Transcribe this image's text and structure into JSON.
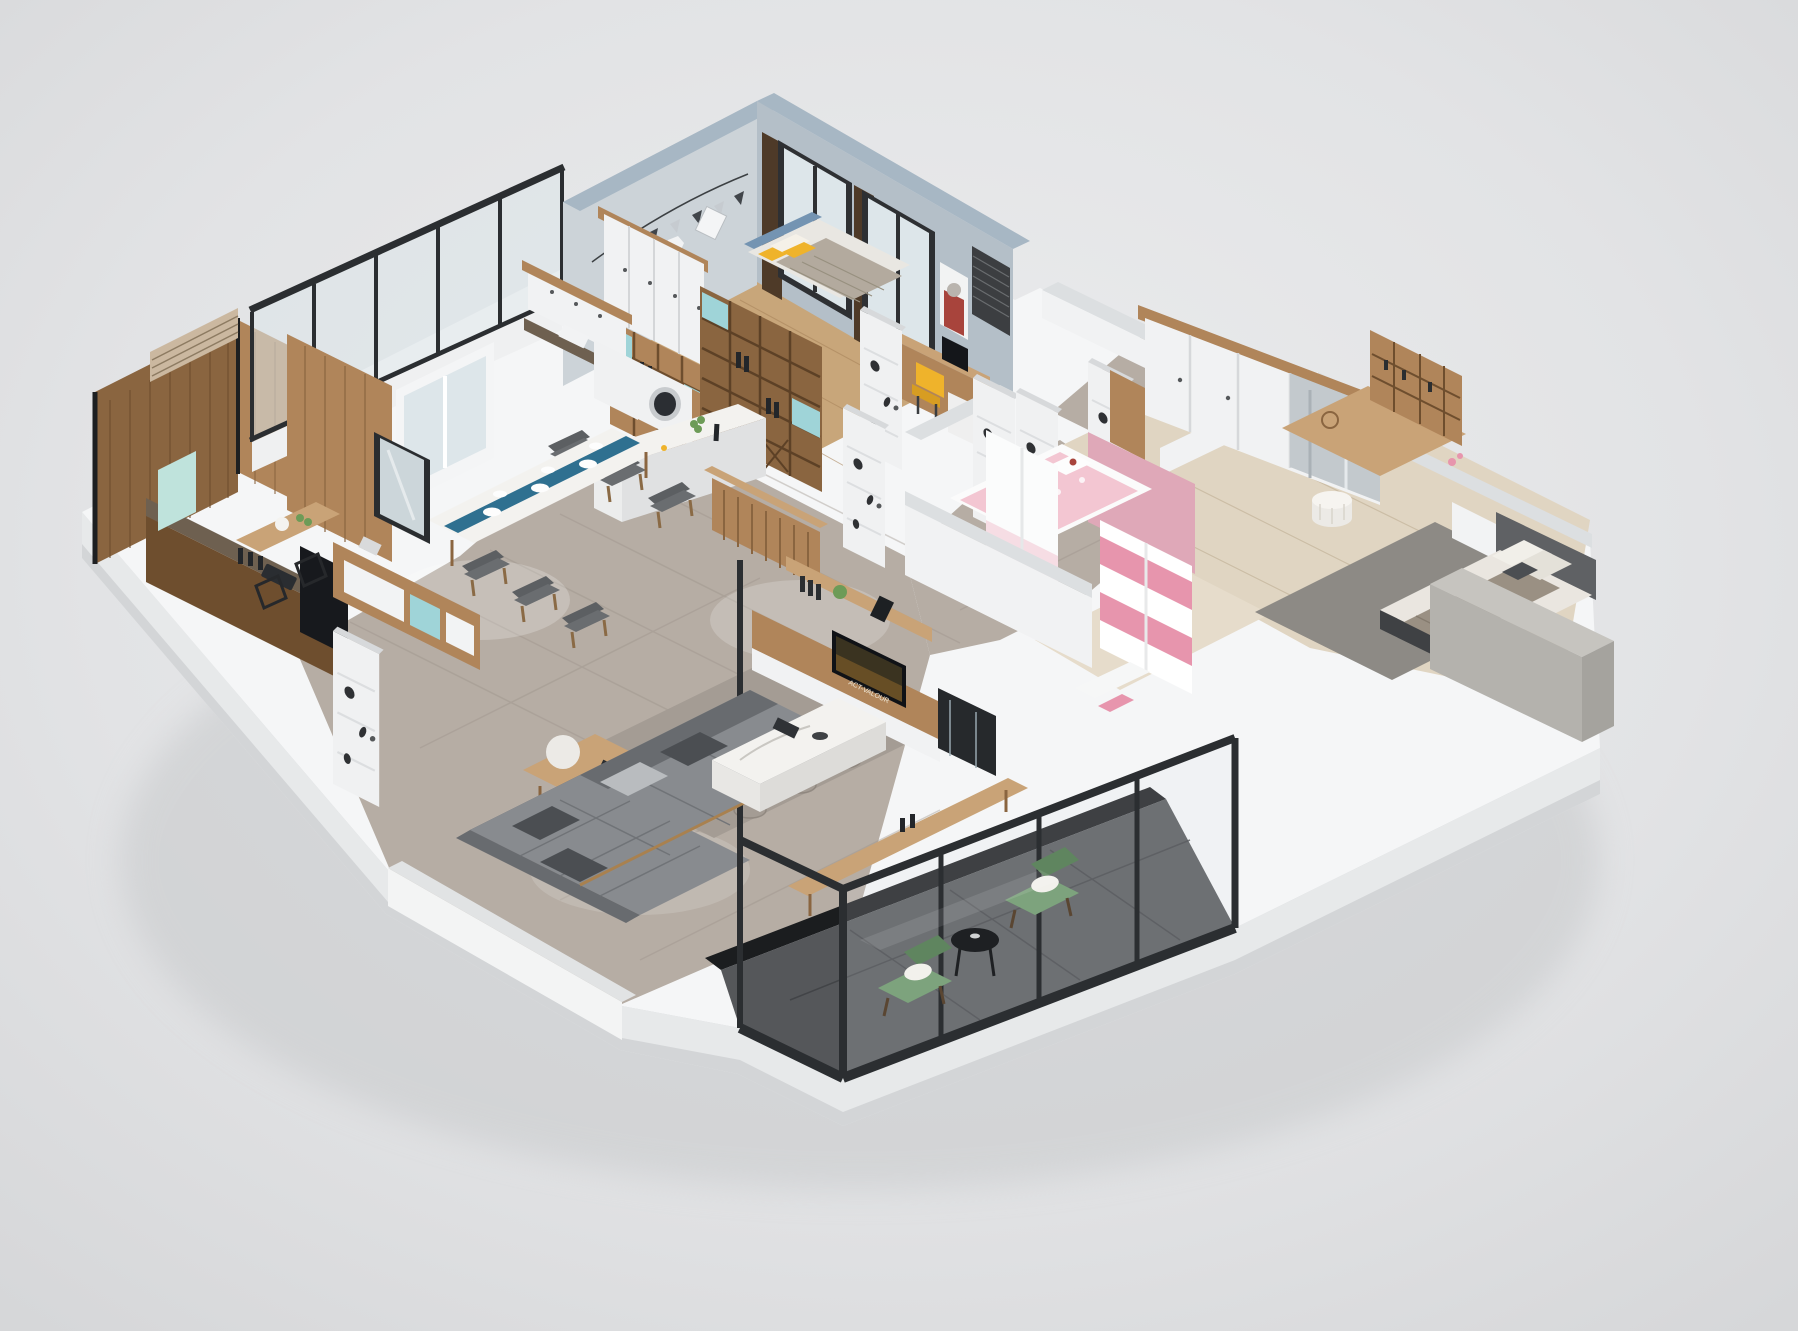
{
  "scene": {
    "view": "isometric-cutaway-apartment",
    "rooms": [
      {
        "id": "boys-bedroom",
        "furniture": [
          "bed",
          "wardrobe",
          "bookshelf",
          "desk",
          "chair",
          "rhino-poster",
          "window-curtains",
          "bunting"
        ]
      },
      {
        "id": "laundry-kitchenette",
        "furniture": [
          "washing-machine",
          "sink-counter",
          "upper-cabinets",
          "shelf-bar-unit",
          "island-bar"
        ]
      },
      {
        "id": "tea-room-kitchen",
        "furniture": [
          "wood-panel-walls",
          "slat-blinds",
          "tea-table",
          "stools",
          "granite-counter",
          "tall-black-cabinet"
        ]
      },
      {
        "id": "dining-area",
        "furniture": [
          "marble-dining-table",
          "table-runner",
          "six-chairs",
          "sideboard",
          "mirror",
          "entry-door"
        ]
      },
      {
        "id": "living-room",
        "furniture": [
          "sectional-sofa",
          "coffee-table",
          "side-table",
          "globe-lamp",
          "patterned-rug",
          "tv-media-wall",
          "display-cabinet"
        ]
      },
      {
        "id": "hallway",
        "furniture": [
          "white-doors",
          "marble-tile-floor"
        ]
      },
      {
        "id": "girls-bedroom",
        "furniture": [
          "hello-kitty-bed",
          "pink-white-wardrobe",
          "pink-desk-chair",
          "pink-wall"
        ]
      },
      {
        "id": "master-bedroom",
        "furniture": [
          "upholstered-bed",
          "long-wardrobe",
          "vanity-desk",
          "hutch-shelves",
          "pouf",
          "nightstand",
          "gray-rug"
        ]
      },
      {
        "id": "balcony",
        "furniture": [
          "black-glass-partition",
          "green-armchairs",
          "round-tea-table",
          "dark-tile-floor"
        ]
      }
    ]
  },
  "tv_poster": {
    "title": "ACT-VALOUR"
  },
  "colors": {
    "background": "#dfe0e2",
    "bg_light": "#ebecee",
    "ground_shadow": "#c7c9cb",
    "plinth": "#f5f6f7",
    "plinth_side": "#e7e9ea",
    "plinth_edge": "#d3d5d7",
    "floor_marble": "#b6ada4",
    "marble_line": "#978d84",
    "floor_wood_boy": "#c8a67a",
    "floor_wood_master": "#e0d5c2",
    "floor_wood_girl": "#e6dccb",
    "rug_living": "#a49c94",
    "rug_master": "#8d8a85",
    "balcony_tile": "#55575a",
    "balcony_line": "#3e4043",
    "marble_black": "#1b1d1f",
    "wall_interior": "#ccd3d8",
    "wall_top_blue": "#a7b7c4",
    "wall_white": "#f1f2f3",
    "wall_cap": "#dcdfe1",
    "wall_pink": "#dfa8b8",
    "glass": "#dde6ea",
    "frame_black": "#2b2e31",
    "wood": "#b0855a",
    "wood_dark": "#8a6540",
    "wood_deep": "#6e4e2e",
    "wood_light": "#c9a377",
    "granite": "#6e6050",
    "appliance_black": "#17191d",
    "washer_white": "#f0f1f2",
    "door_white": "#f0f1f2",
    "door_edge": "#d7d9db",
    "teal": "#9fd4d8",
    "runner_teal": "#2f7090",
    "marble_white": "#f3f2ef",
    "sofa": "#888b8f",
    "sofa_dark": "#686b6f",
    "pillow_dark": "#4b4e52",
    "pillow_light": "#b9bcbf",
    "yellow": "#efb32b",
    "chair_gray": "#5c5f62",
    "bed_blue": "#7494b2",
    "blanket_gray": "#b3aa9e",
    "bed_pink": "#f3c6d2",
    "pink_strong": "#e795ad",
    "pink_light": "#f6dde4",
    "headboard_gray": "#5f6164",
    "bed_white": "#eae6e0",
    "blanket_master": "#9a9083",
    "bed_base": "#3f4144",
    "green_chair": "#7da37d",
    "green_chair_dark": "#5f855f",
    "cushion_white": "#f2f1ec",
    "gray_block": "#b4b2ad",
    "gray_block_top": "#c6c4bf",
    "gray_block_side": "#a5a39e",
    "curtain_brown": "#4e3a28",
    "blind_dark": "#3c3e41",
    "poster_red": "#a8443c",
    "rhino_gray": "#b9b4ae",
    "mirror_glass": "#ccd6da",
    "mint_panel": "#bfe3dc",
    "lamp_white": "#eceae6",
    "table_black": "#1e2023",
    "plant_green": "#6d9b57",
    "wine_dark": "#23262a"
  }
}
